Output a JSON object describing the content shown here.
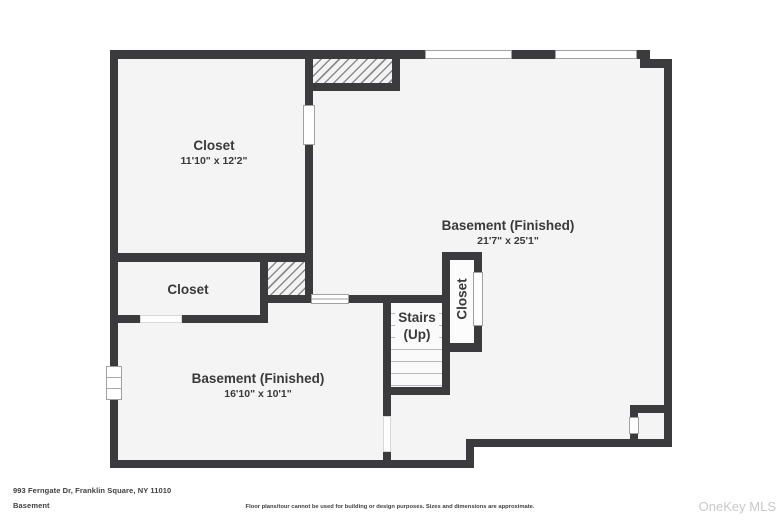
{
  "plan": {
    "rooms": {
      "closet_top": {
        "name": "Closet",
        "dims": "11'10\" x 12'2\""
      },
      "basement_right": {
        "name": "Basement (Finished)",
        "dims": "21'7\" x 25'1\""
      },
      "closet_mid": {
        "name": "Closet"
      },
      "stairs": {
        "name": "Stairs",
        "sub": "(Up)"
      },
      "closet_vertical": {
        "name": "Closet"
      },
      "basement_left": {
        "name": "Basement (Finished)",
        "dims": "16'10\" x 10'1\""
      }
    }
  },
  "footer": {
    "address": "993 Ferngate Dr, Franklin Square, NY 11010",
    "floor": "Basement",
    "disclaimer": "Floor plans/tour cannot be used for building or design purposes. Sizes and dimensions are approximate.",
    "watermark": "OneKey MLS"
  },
  "colors": {
    "wall": "#3b3b3d",
    "floor": "#f4f4f4",
    "text": "#3a3a3a",
    "watermark": "#c9c9c9",
    "paper": "#ffffff"
  }
}
